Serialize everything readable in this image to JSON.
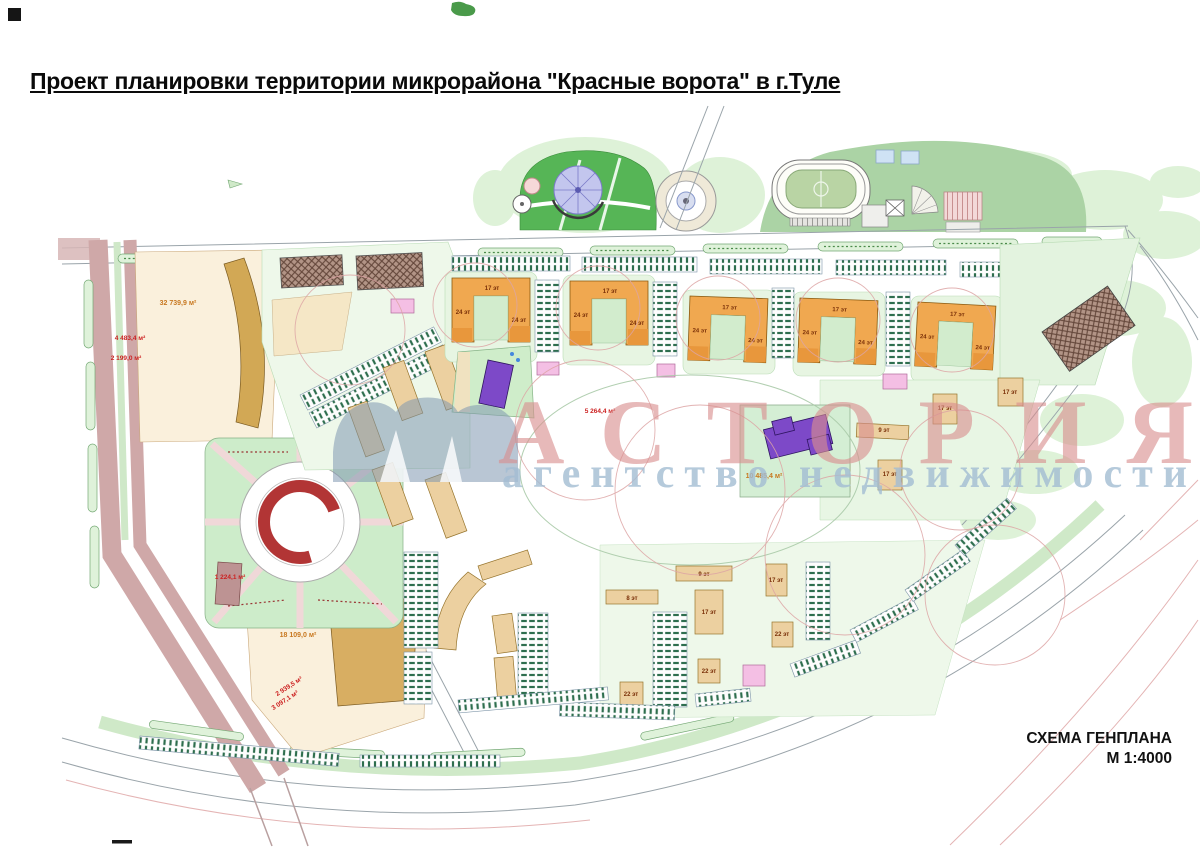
{
  "page": {
    "title": "Проект планировки территории микрорайона \"Красные ворота\" в г.Туле"
  },
  "titleblock": {
    "scheme_name": "СХЕМА ГЕНПЛАНА",
    "scale": "М 1:4000"
  },
  "watermark": {
    "brand": "АСТОРИЯ",
    "subtitle": "агентство недвижимости"
  },
  "map": {
    "floor_labels": {
      "f4": "4 эт",
      "f8": "8 эт",
      "f9": "9 эт",
      "f14": "14 эт",
      "f17": "17 эт",
      "f22": "22 эт",
      "f24": "24 эт"
    },
    "area_labels": {
      "left_block": "32 739,9 м²",
      "avenue_1": "4 483,4 м²",
      "avenue_2": "2 199,0 м²",
      "plaza": "1 224,1 м²",
      "southwest_block": "18 109,0 м²",
      "road_1": "2 939,5 м²",
      "road_2": "3 097,1 м²",
      "central_park": "5 264,4 м²",
      "school_site": "10 485,4 м²"
    },
    "colors": {
      "residential_orange": "#f0a850",
      "slab_tan": "#ecd0a0",
      "greenery": "#d9f0d4",
      "social_purple": "#7d49c8",
      "substation_pink": "#f4bfe4",
      "road_mauve": "#cfa8a8",
      "accent_red": "#b23535"
    }
  }
}
